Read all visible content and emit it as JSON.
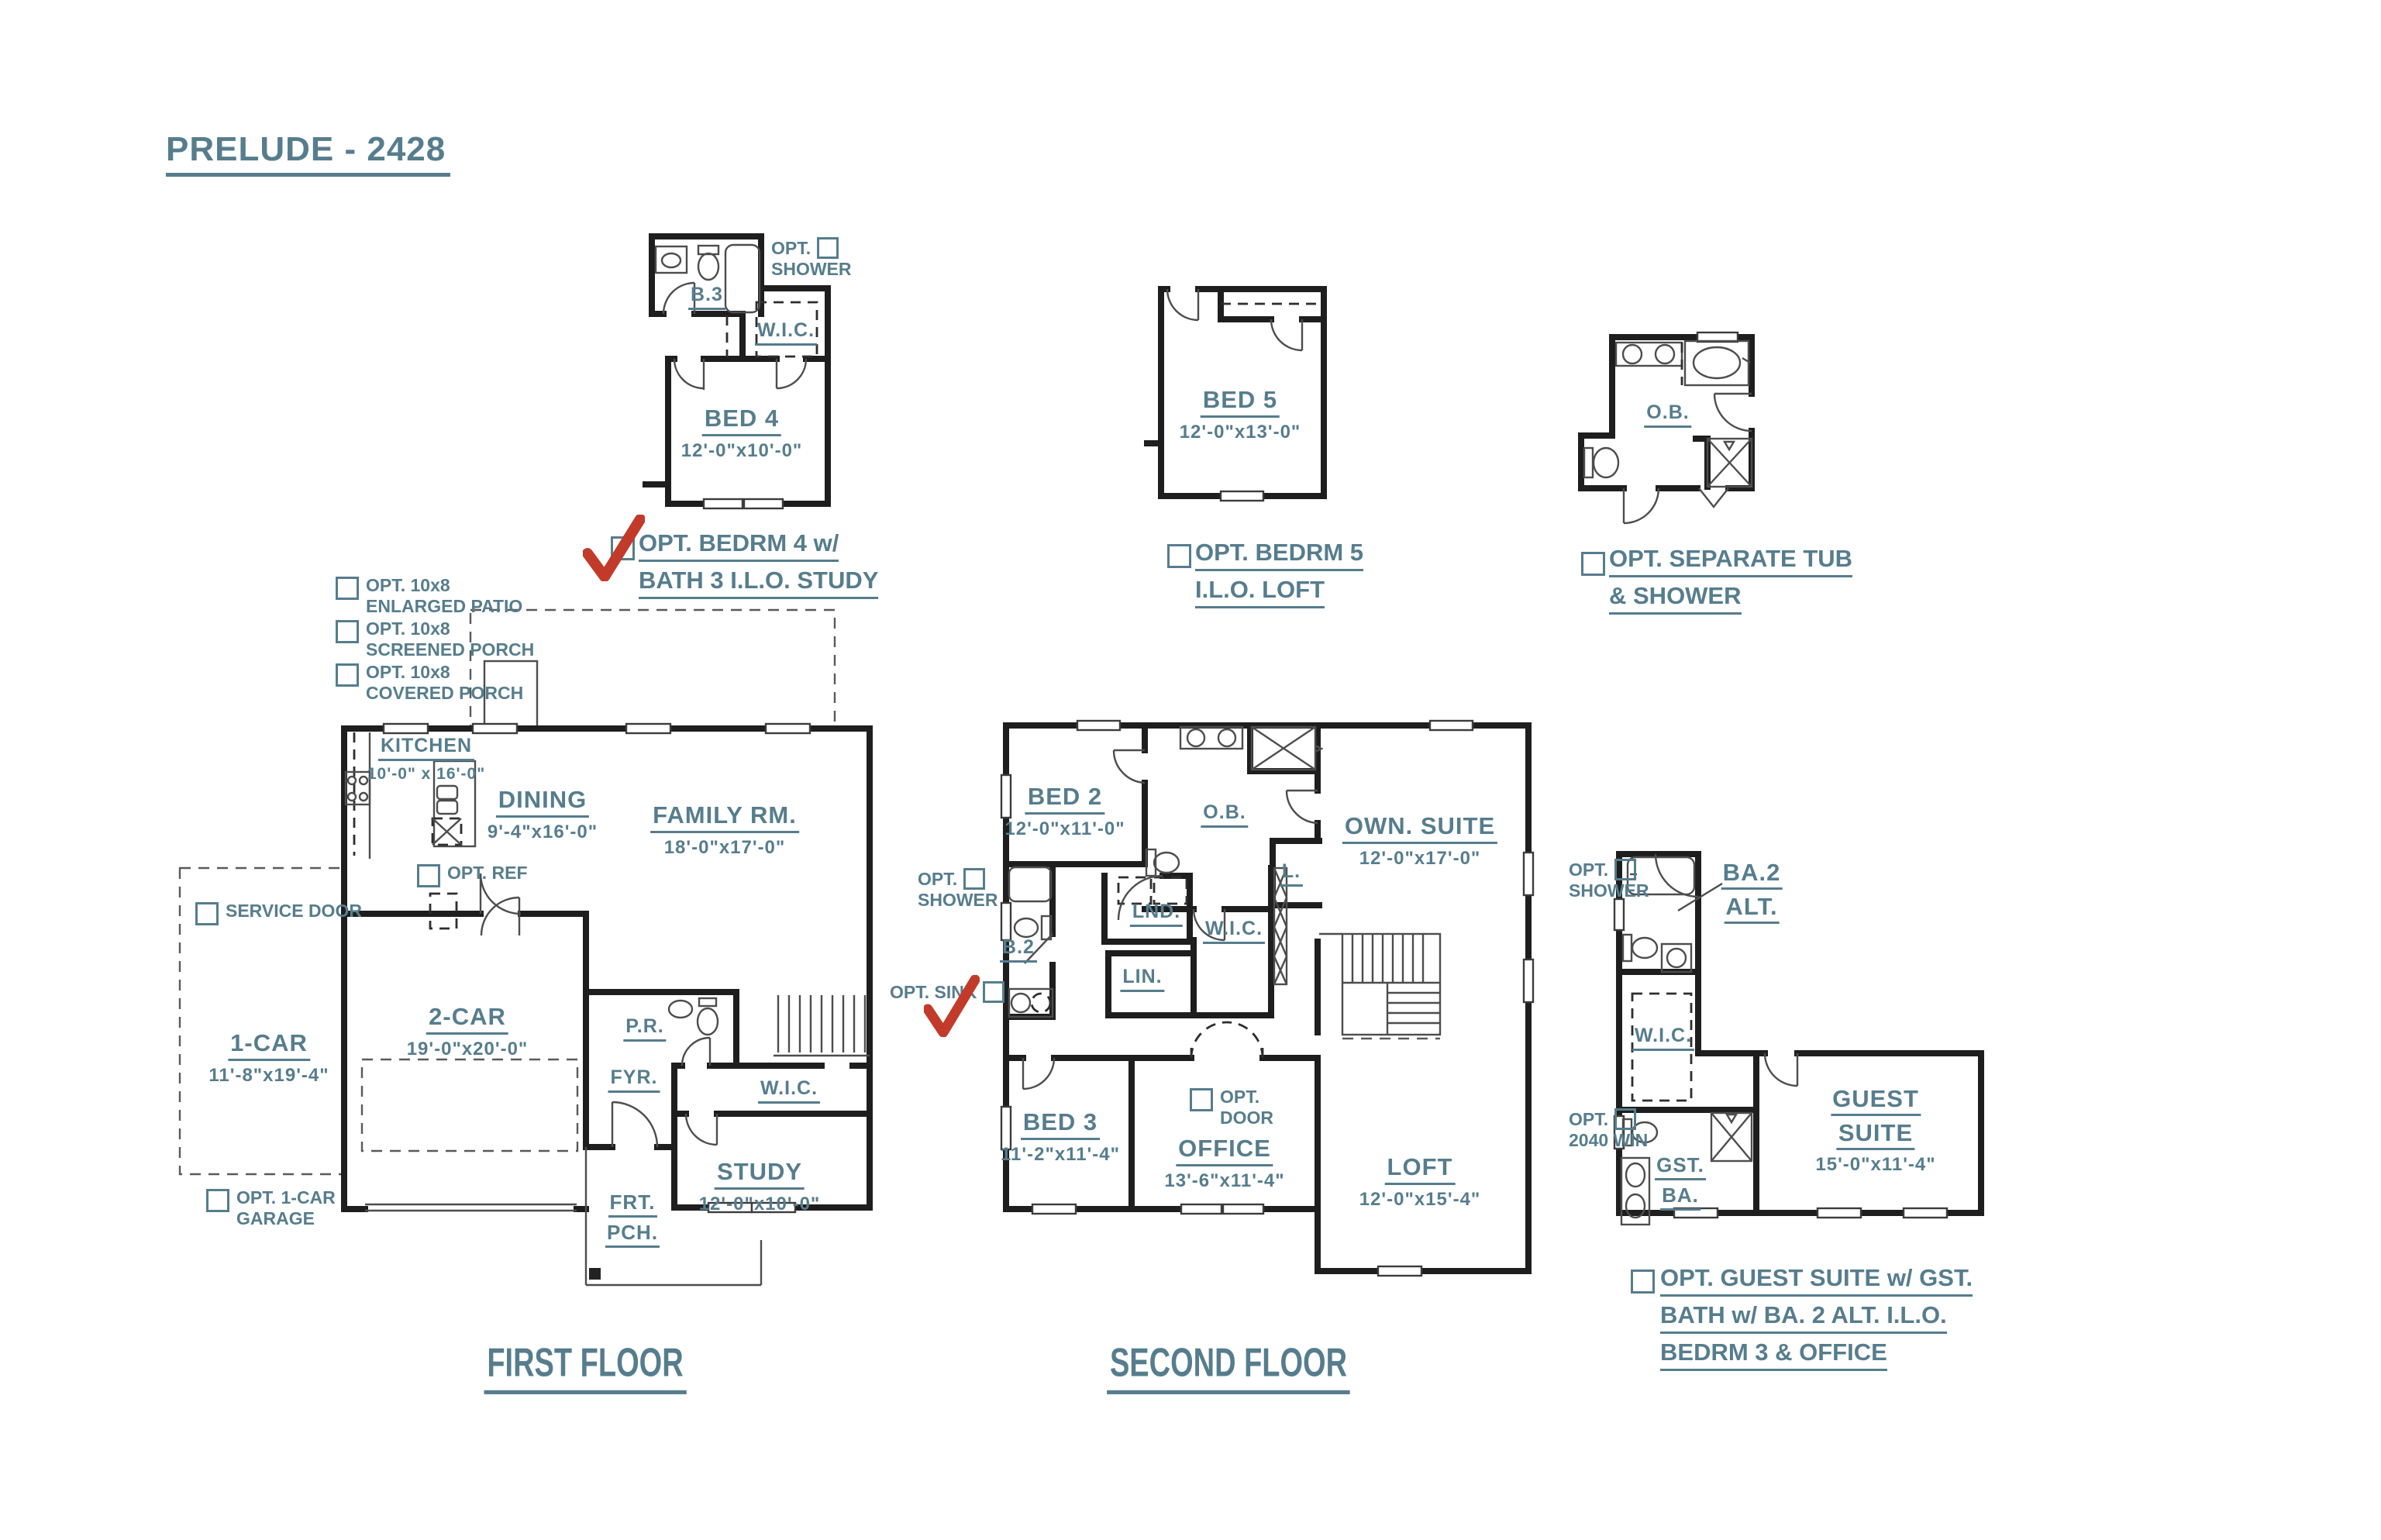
{
  "title": "PRELUDE - 2428",
  "colors": {
    "accent": "#567d8d",
    "wall": "#1e1e1e",
    "thin_line": "#4d4d4d",
    "checkmark_red": "#c23b2a"
  },
  "opt_bed4": {
    "shower_opt": {
      "l1": "OPT.",
      "l2": "SHOWER"
    },
    "bath_label": "B.3",
    "wic_label": "W.I.C.",
    "room": {
      "name": "BED 4",
      "dims": "12'-0\"x10'-0\""
    },
    "caption": {
      "l1": "OPT.  BEDRM 4 w/",
      "l2": "BATH 3 I.L.O. STUDY",
      "checked": true
    }
  },
  "opt_bed5": {
    "room": {
      "name": "BED 5",
      "dims": "12'-0\"x13'-0\""
    },
    "caption": {
      "l1": "OPT.  BEDRM 5",
      "l2": "I.L.O. LOFT",
      "checked": false
    }
  },
  "opt_tub": {
    "bath_label": "O.B.",
    "caption": {
      "l1": "OPT.  SEPARATE TUB",
      "l2": "& SHOWER",
      "checked": false
    }
  },
  "first_floor": {
    "label": "FIRST FLOOR",
    "options": {
      "patio": {
        "l1": "OPT. 10x8",
        "l2": "ENLARGED PATIO"
      },
      "screened": {
        "l1": "OPT. 10x8",
        "l2": "SCREENED PORCH"
      },
      "covered": {
        "l1": "OPT. 10x8",
        "l2": "COVERED PORCH"
      },
      "service": {
        "l1": "SERVICE DOOR"
      },
      "ref": {
        "l1": "OPT. REF"
      },
      "garage": {
        "l1": "OPT. 1-CAR",
        "l2": "GARAGE"
      }
    },
    "rooms": {
      "kitchen": {
        "name": "KITCHEN",
        "dims": "10'-0\" x 16'-0\""
      },
      "dining": {
        "name": "DINING",
        "dims": "9'-4\"x16'-0\""
      },
      "family": {
        "name": "FAMILY RM.",
        "dims": "18'-0\"x17'-0\""
      },
      "one_car": {
        "name": "1-CAR",
        "dims": "11'-8\"x19'-4\""
      },
      "two_car": {
        "name": "2-CAR",
        "dims": "19'-0\"x20'-0\""
      },
      "pr": {
        "name": "P.R."
      },
      "fyr": {
        "name": "FYR."
      },
      "wic": {
        "name": "W.I.C."
      },
      "study": {
        "name": "STUDY",
        "dims": "12'-0\"x10'-0\""
      },
      "porch": {
        "l1": "FRT.",
        "l2": "PCH."
      }
    }
  },
  "second_floor": {
    "label": "SECOND FLOOR",
    "options": {
      "shower": {
        "l1": "OPT.",
        "l2": "SHOWER"
      },
      "sink": {
        "l1": "OPT. SINK",
        "checked": true
      },
      "door": {
        "l1": "OPT.",
        "l2": "DOOR"
      }
    },
    "rooms": {
      "bed2": {
        "name": "BED 2",
        "dims": "12'-0\"x11'-0\""
      },
      "ob": {
        "name": "O.B."
      },
      "own_suite": {
        "name": "OWN. SUITE",
        "dims": "12'-0\"x17'-0\""
      },
      "linen_l": {
        "name": "L."
      },
      "laundry": {
        "name": "LND."
      },
      "wic": {
        "name": "W.I.C."
      },
      "lin": {
        "name": "LIN."
      },
      "b2": {
        "name": "B.2"
      },
      "bed3": {
        "name": "BED 3",
        "dims": "11'-2\"x11'-4\""
      },
      "office": {
        "name": "OFFICE",
        "dims": "13'-6\"x11'-4\""
      },
      "loft": {
        "name": "LOFT",
        "dims": "12'-0\"x15'-4\""
      }
    }
  },
  "opt_guest": {
    "options": {
      "shower": {
        "l1": "OPT.",
        "l2": "SHOWER"
      },
      "win": {
        "l1": "OPT.",
        "l2": "2040 WIN"
      }
    },
    "rooms": {
      "ba2alt": {
        "l1": "BA.2",
        "l2": "ALT."
      },
      "wic": {
        "name": "W.I.C."
      },
      "gstba": {
        "l1": "GST.",
        "l2": "BA."
      },
      "guest": {
        "l1": "GUEST",
        "l2": "SUITE",
        "dims": "15'-0\"x11'-4\""
      }
    },
    "caption": {
      "l1": "OPT.  GUEST SUITE w/ GST.",
      "l2": "BATH w/ BA. 2 ALT. I.L.O.",
      "l3": "BEDRM 3 & OFFICE",
      "checked": false
    }
  }
}
